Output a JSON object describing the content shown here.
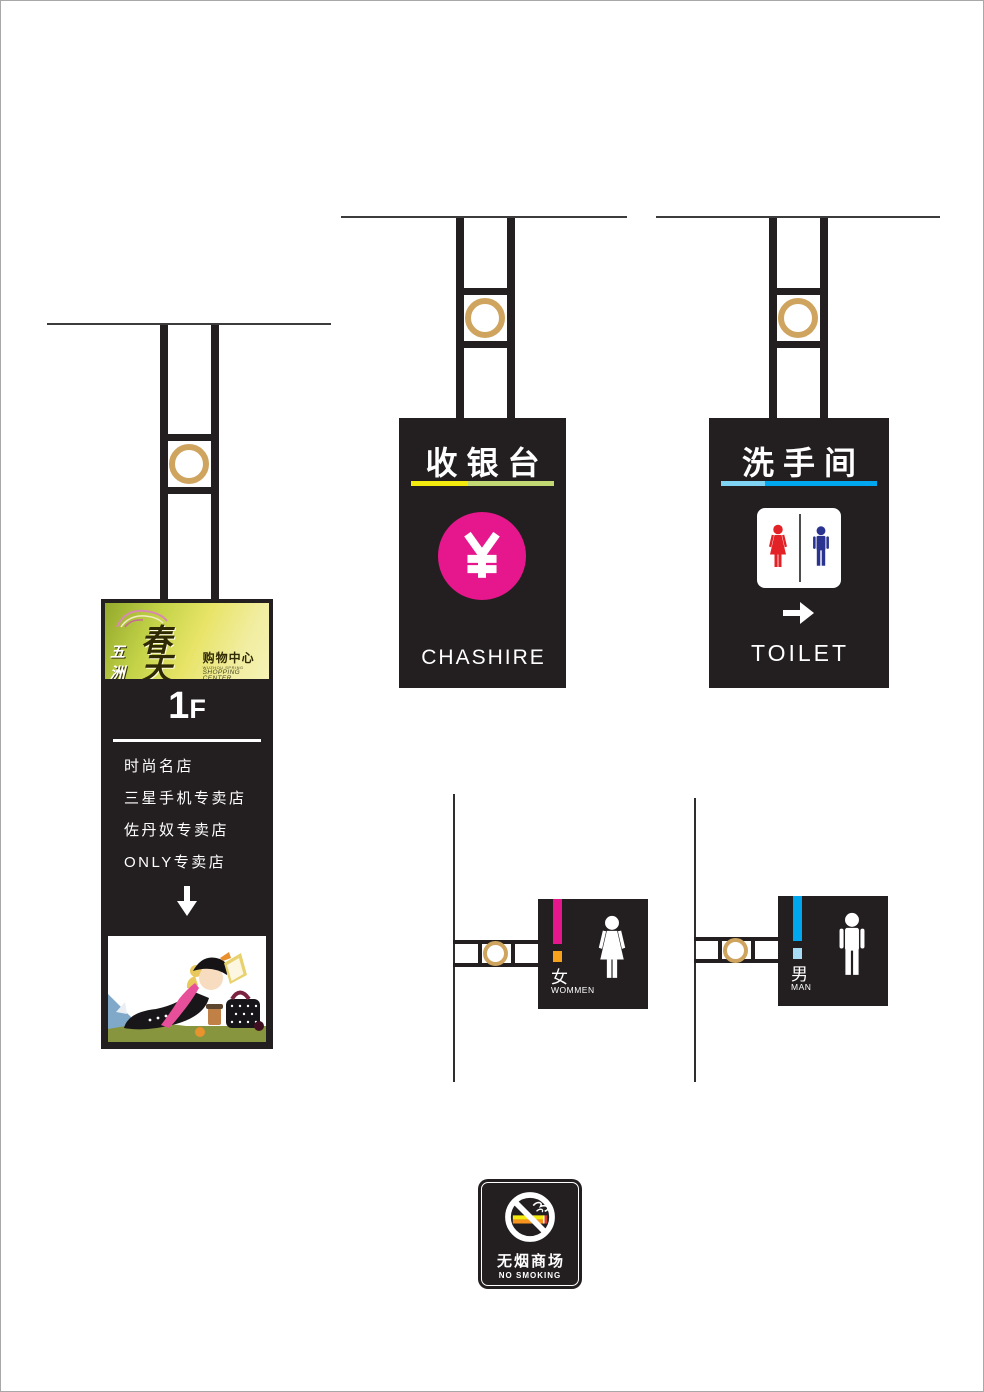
{
  "directory_sign": {
    "logo": {
      "brand_cn_prefix": "五洲",
      "brand_cn_main": "春天",
      "brand_cn_suffix": "购物中心",
      "brand_en_small": "WUZHOU SPRING",
      "brand_en": "SHOPPING CENTER"
    },
    "floor_number": "1",
    "floor_suffix": "F",
    "stores": [
      "时尚名店",
      "三星手机专卖店",
      "佐丹奴专卖店",
      "ONLY专卖店"
    ]
  },
  "cashier_sign": {
    "title_cn": "收银台",
    "currency_symbol": "¥",
    "subtitle_en": "CHASHIRE"
  },
  "restroom_sign": {
    "title_cn": "洗手间",
    "subtitle_en": "TOILET"
  },
  "women_sign": {
    "label_cn": "女",
    "label_en": "WOMMEN"
  },
  "men_sign": {
    "label_cn": "男",
    "label_en": "MAN"
  },
  "no_smoking_sign": {
    "label_cn": "无烟商场",
    "label_en": "NO SMOKING"
  },
  "colors": {
    "sign_black": "#231f20",
    "gold_ring": "#cfa45f",
    "magenta": "#e6168c",
    "yellow": "#f2ea0f",
    "yellow_green": "#c2d872",
    "light_blue": "#7fd4f3",
    "blue": "#00a7ee",
    "woman_red": "#e32227",
    "man_navy": "#2b3390",
    "orange": "#f7a21d",
    "pale_blue": "#a8dcf4"
  }
}
